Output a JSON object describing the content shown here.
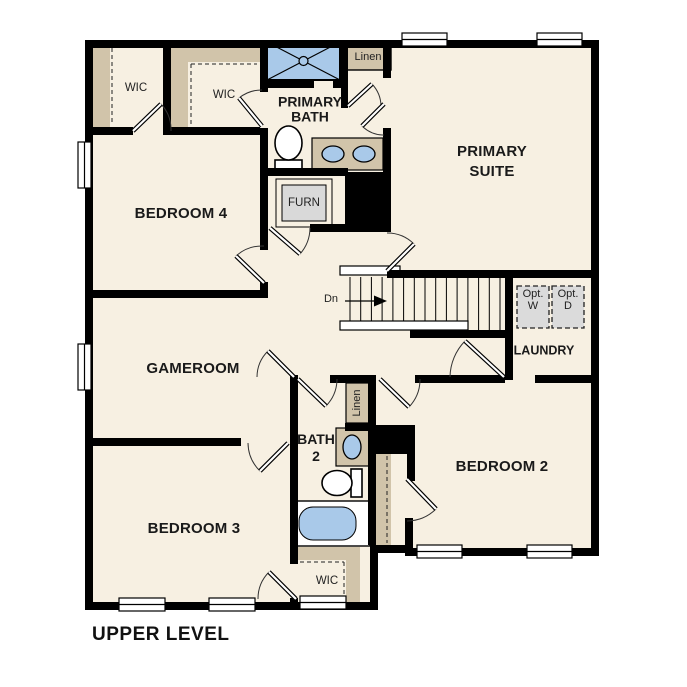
{
  "title": {
    "label": "UPPER LEVEL"
  },
  "colors": {
    "wall": "#000000",
    "floor": "#F7F0E2",
    "casework_tan": "#D1C4AA",
    "fixture_blue": "#A9C9E9",
    "appliance_gray": "#DBDBDB",
    "exterior": "#FFFFFF"
  },
  "rooms": {
    "primary_suite": {
      "lines": [
        "PRIMARY",
        "SUITE"
      ]
    },
    "primary_bath": {
      "lines": [
        "PRIMARY",
        "BATH"
      ]
    },
    "bath_2": {
      "lines": [
        "BATH",
        "2"
      ]
    },
    "bedroom_2": {
      "label": "BEDROOM 2"
    },
    "bedroom_3": {
      "label": "BEDROOM 3"
    },
    "bedroom_4": {
      "label": "BEDROOM 4"
    },
    "gameroom": {
      "label": "GAMEROOM"
    },
    "laundry": {
      "label": "LAUNDRY"
    }
  },
  "closets": {
    "wic_bedroom4": {
      "label": "WIC"
    },
    "wic_primary": {
      "label": "WIC"
    },
    "wic_bedroom3": {
      "label": "WIC"
    },
    "linen_upper": {
      "label": "Linen"
    },
    "linen_bath2": {
      "label": "Linen"
    }
  },
  "fixtures": {
    "furnace": {
      "label": "FURN"
    },
    "stairs": {
      "direction_label": "Dn"
    },
    "opt_washer": {
      "lines": [
        "Opt.",
        "W"
      ]
    },
    "opt_dryer": {
      "lines": [
        "Opt.",
        "D"
      ]
    }
  }
}
